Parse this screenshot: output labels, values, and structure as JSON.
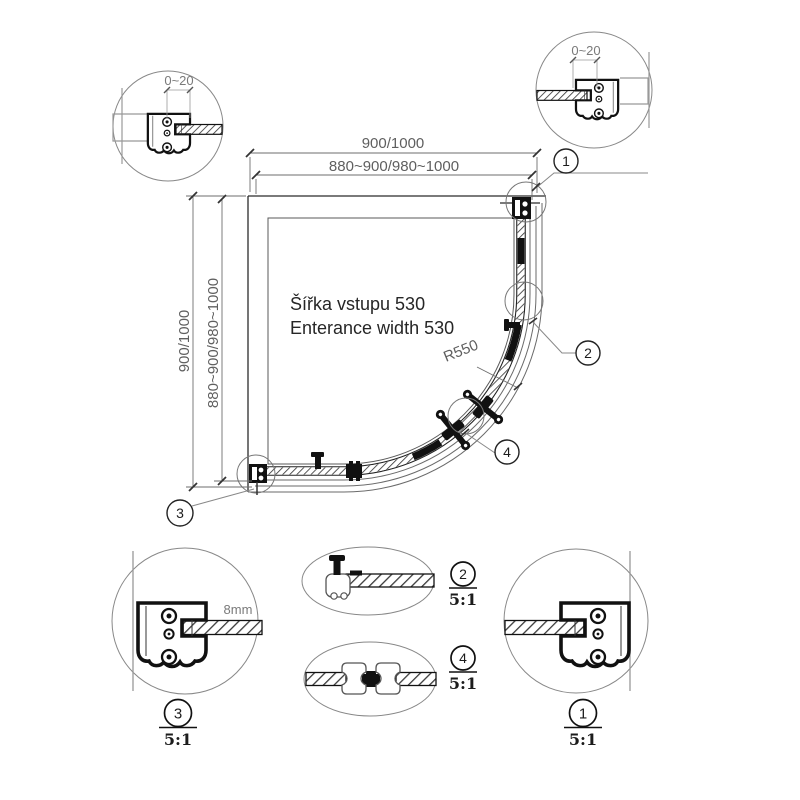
{
  "dimensions": {
    "top_outer": "900/1000",
    "top_inner": "880~900/980~1000",
    "left_outer": "900/1000",
    "left_inner": "880~900/980~1000",
    "wall_adjust_left": "0~20",
    "wall_adjust_right": "0~20",
    "radius": "R550",
    "glass_thickness": "8mm"
  },
  "labels": {
    "entrance_cs": "Šířka vstupu 530",
    "entrance_en": "Enterance width 530"
  },
  "callouts": {
    "c1": "1",
    "c2": "2",
    "c3": "3",
    "c4": "4"
  },
  "details": {
    "d1": {
      "number": "1",
      "scale": "5:1"
    },
    "d2": {
      "number": "2",
      "scale": "5:1"
    },
    "d3": {
      "number": "3",
      "scale": "5:1"
    },
    "d4": {
      "number": "4",
      "scale": "5:1"
    }
  },
  "colors": {
    "line": "#2b2b2b",
    "dim": "#6e6e6e",
    "hatch": "#3a3a3a",
    "background": "#ffffff"
  }
}
